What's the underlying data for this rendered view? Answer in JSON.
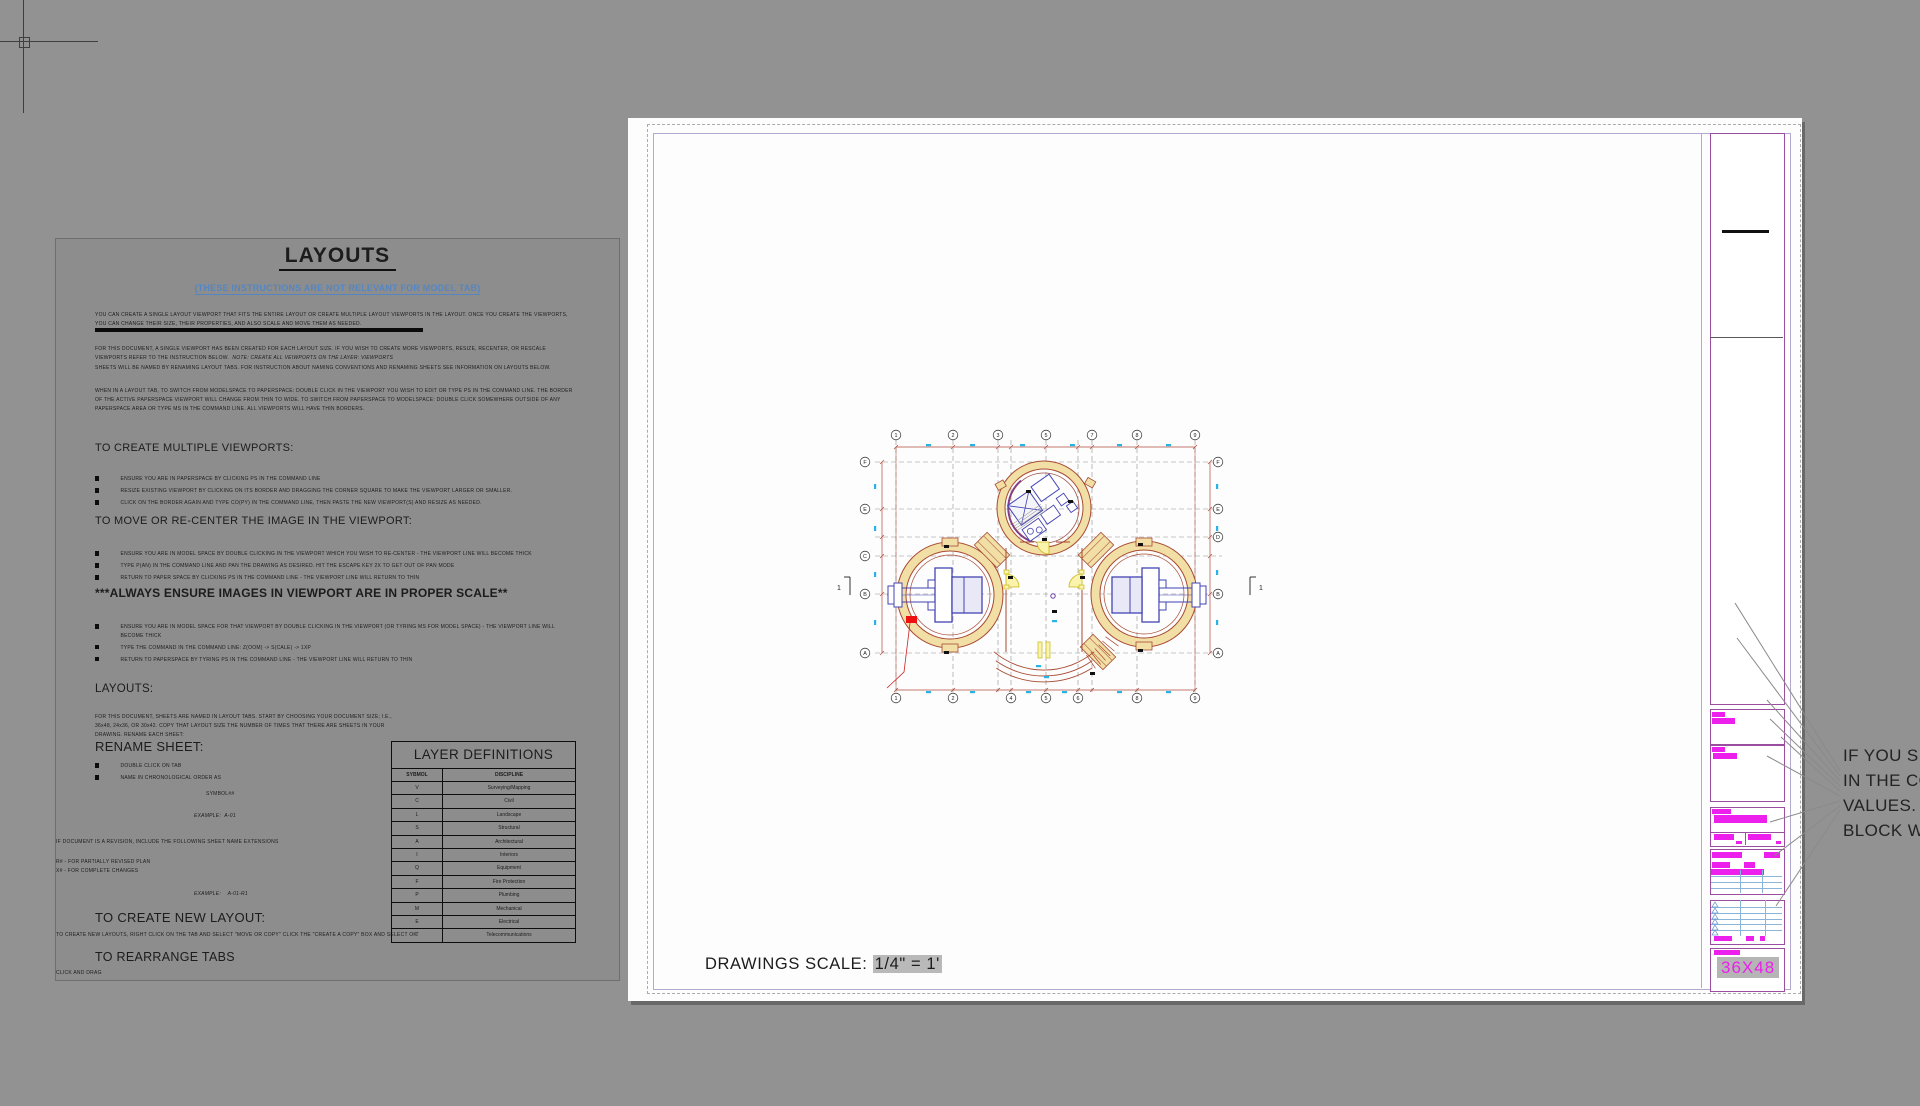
{
  "document": {
    "title": "LAYOUTS",
    "subtitle": "(THESE INSTRUCTIONS ARE NOT RELEVANT FOR MODEL TAB)",
    "p1": "YOU CAN CREATE A SINGLE LAYOUT VIEWPORT THAT FITS THE ENTIRE LAYOUT OR CREATE MULTIPLE LAYOUT VIEWPORTS IN THE LAYOUT.  ONCE YOU CREATE THE VIEWPORTS, YOU CAN CHANGE THEIR SIZE, THEIR PROPERTIES, AND ALSO SCALE AND MOVE THEM AS NEEDED.",
    "p2": "FOR THIS DOCUMENT, A SINGLE VIEWPORT HAS BEEN CREATED FOR EACH LAYOUT SIZE.  IF YOU WISH TO CREATE MORE VIEWPORTS, RESIZE, RECENTER, OR RESCALE VIEWPORTS REFER TO THE INSTRUCTION BELOW.",
    "p2_note": "NOTE: CREATE ALL VEIWPORTS ON THE LAYER: VIEWPORTS",
    "p3": "SHEETS WILL BE NAMED BY RENAMING LAYOUT TABS.  FOR INSTRUCTION ABOUT NAMING CONVENTIONS AND RENAMING SHEETS SEE INFORMATION ON LAYOUTS BELOW.",
    "p4": "WHEN IN A LAYOUT TAB, TO SWITCH FROM MODELSPACE TO PAPERSPACE: DOUBLE CLICK IN THE VIEWPORT YOU WISH TO EDIT OR TYPE PS IN THE COMMAND LINE.  THE BORDER OF THE ACTIVE PAPERSPACE VIEWPORT WILL CHANGE FROM THIN TO WIDE.  TO SWITCH FROM PAPERSPACE TO MODELSPACE: DOUBLE CLICK SOMEWHERE OUTSIDE OF ANY PAPERSPACE AREA OR TYPE MS IN THE COMMAND LINE.  ALL VIEWPORTS WILL HAVE THIN BORDERS.",
    "sections": [
      {
        "heading": "TO CREATE MULTIPLE VIEWPORTS:",
        "bullets": [
          "ENSURE YOU ARE IN PAPERSPACE BY CLICKING PS IN THE COMMAND LINE",
          "RESIZE EXISTING VIEWPORT BY CLICKING ON ITS BORDER AND DRAGGING THE CORNER SQUARE TO MAKE THE VIEWPORT LARGER OR SMALLER.",
          "CLICK ON THE BORDER AGAIN AND TYPE CO(PY) IN THE COMMAND LINE, THEN PASTE THE NEW VIEWPORT(S) AND RESIZE AS NEEDED."
        ]
      },
      {
        "heading": "TO MOVE OR RE-CENTER THE IMAGE IN THE VIEWPORT:",
        "bullets": [
          "ENSURE YOU ARE IN MODEL SPACE BY DOUBLE CLICKING IN THE VIEWPORT WHICH YOU WISH TO RE-CENTER - THE VIEWPORT LINE WILL BECOME THICK",
          "TYPE P(AN) IN THE COMMAND LINE AND PAN THE DRAWING AS DESIRED. HIT THE ESCAPE KEY 2X TO GET OUT OF PAN MODE",
          "RETURN TO PAPER SPACE BY CLICKING PS IN THE COMMAND LINE - THE VIEWPORT LINE WILL RETURN TO THIN"
        ]
      },
      {
        "heading": "***ALWAYS ENSURE IMAGES IN VIEWPORT ARE IN PROPER SCALE**",
        "bullets": [
          "ENSURE YOU ARE IN MODEL SPACE FOR THAT VIEWPORT BY DOUBLE CLICKING IN THE VIEWPORT (OR TYRING MS FOR MODEL SPACE) - THE VIEWPORT LINE WILL BECOME THICK",
          "TYPE THE COMMAND IN THE COMMAND LINE: Z(OOM) -> S(CALE) -> 1XP",
          "RETURN TO PAPERSPACE BY TYRING PS IN THE COMMAND LINE - THE VIEWPORT LINE WILL RETURN TO THIN"
        ]
      }
    ],
    "layouts_heading": "LAYOUTS:",
    "layouts_body": "FOR THIS DOCUMENT, SHEETS ARE NAMED IN LAYOUT TABS.  START BY CHOOSING YOUR DOCUMENT SIZE; I.E., 36x48, 24x36, OR 30x42.  COPY THAT LAYOUT SIZE THE NUMBER OF TIMES THAT THERE ARE SHEETS IN YOUR DRAWING.  RENAME EACH SHEET:",
    "rename_heading": "RENAME SHEET:",
    "rename_bullets": [
      "DOUBLE CLICK ON TAB",
      "NAME IN CHRONOLOGICAL ORDER AS"
    ],
    "symbol_line": "SYMBOL##",
    "example1_label": "EXAMPLE:",
    "example1_value": "A-01",
    "revision_note": "IF DOCUMENT IS A REVISION, INCLUDE THE FOLLOWING SHEET NAME EXTENSIONS",
    "r_line": "R# - FOR PARTIALLY REVISED PLAN",
    "x_line": "X# - FOR COMPLETE CHANGES",
    "example2_label": "EXAMPLE:",
    "example2_value": "A-01-R1",
    "newlayout_heading": "TO CREATE NEW LAYOUT:",
    "newlayout_body": "TO CREATE NEW LAYOUTS, RIGHT CLICK ON THE TAB AND SELECT \"MOVE OR COPY\" CLICK THE \"CREATE A COPY\" BOX AND SELECT OK",
    "rearrange_heading": "TO REARRANGE TABS",
    "rearrange_body": "CLICK AND DRAG"
  },
  "layer_table": {
    "title": "LAYER DEFINITIONS",
    "columns": [
      "SYBMOL",
      "DISCIPLINE"
    ],
    "rows": [
      [
        "V",
        "Surveying/Mapping"
      ],
      [
        "C",
        "Civil"
      ],
      [
        "L",
        "Landscape"
      ],
      [
        "S",
        "Structural"
      ],
      [
        "A",
        "Architectural"
      ],
      [
        "I",
        "Interiors"
      ],
      [
        "Q",
        "Equipment"
      ],
      [
        "F",
        "Fire Protection"
      ],
      [
        "P",
        "Plumbing"
      ],
      [
        "M",
        "Mechanical"
      ],
      [
        "E",
        "Electrical"
      ],
      [
        "T",
        "Telecommunications"
      ]
    ]
  },
  "sheet": {
    "scale_label": "DRAWINGS SCALE:",
    "scale_value": "1/4\" = 1'",
    "size_label": "36X48"
  },
  "note": {
    "lines": [
      "IF YOU SEE #",
      "IN THE COMM",
      "VALUES.  SA",
      "BLOCK WITH"
    ]
  },
  "plan": {
    "top_labels": [
      "1",
      "2",
      "3",
      "5",
      "7",
      "8",
      "9"
    ],
    "bottom_labels": [
      "1",
      "2",
      "4",
      "5",
      "6",
      "8",
      "9"
    ],
    "left_labels": [
      "F",
      "E",
      "C",
      "B",
      "A"
    ],
    "right_labels": [
      "F",
      "E",
      "D",
      "B",
      "A"
    ],
    "section_marker": "1"
  },
  "colors": {
    "magenta": "#ec1fec",
    "title_block_purple": "#9b4ea0",
    "viewport_lavender": "#b3a9cf",
    "subtitle_blue": "#5486c4",
    "wall_tan": "#f1dfa6",
    "wall_red": "#a84a32",
    "equipment_blue": "#4444b4",
    "dimension_cyan": "#2ab2e8",
    "alert_red": "#ee1111"
  }
}
